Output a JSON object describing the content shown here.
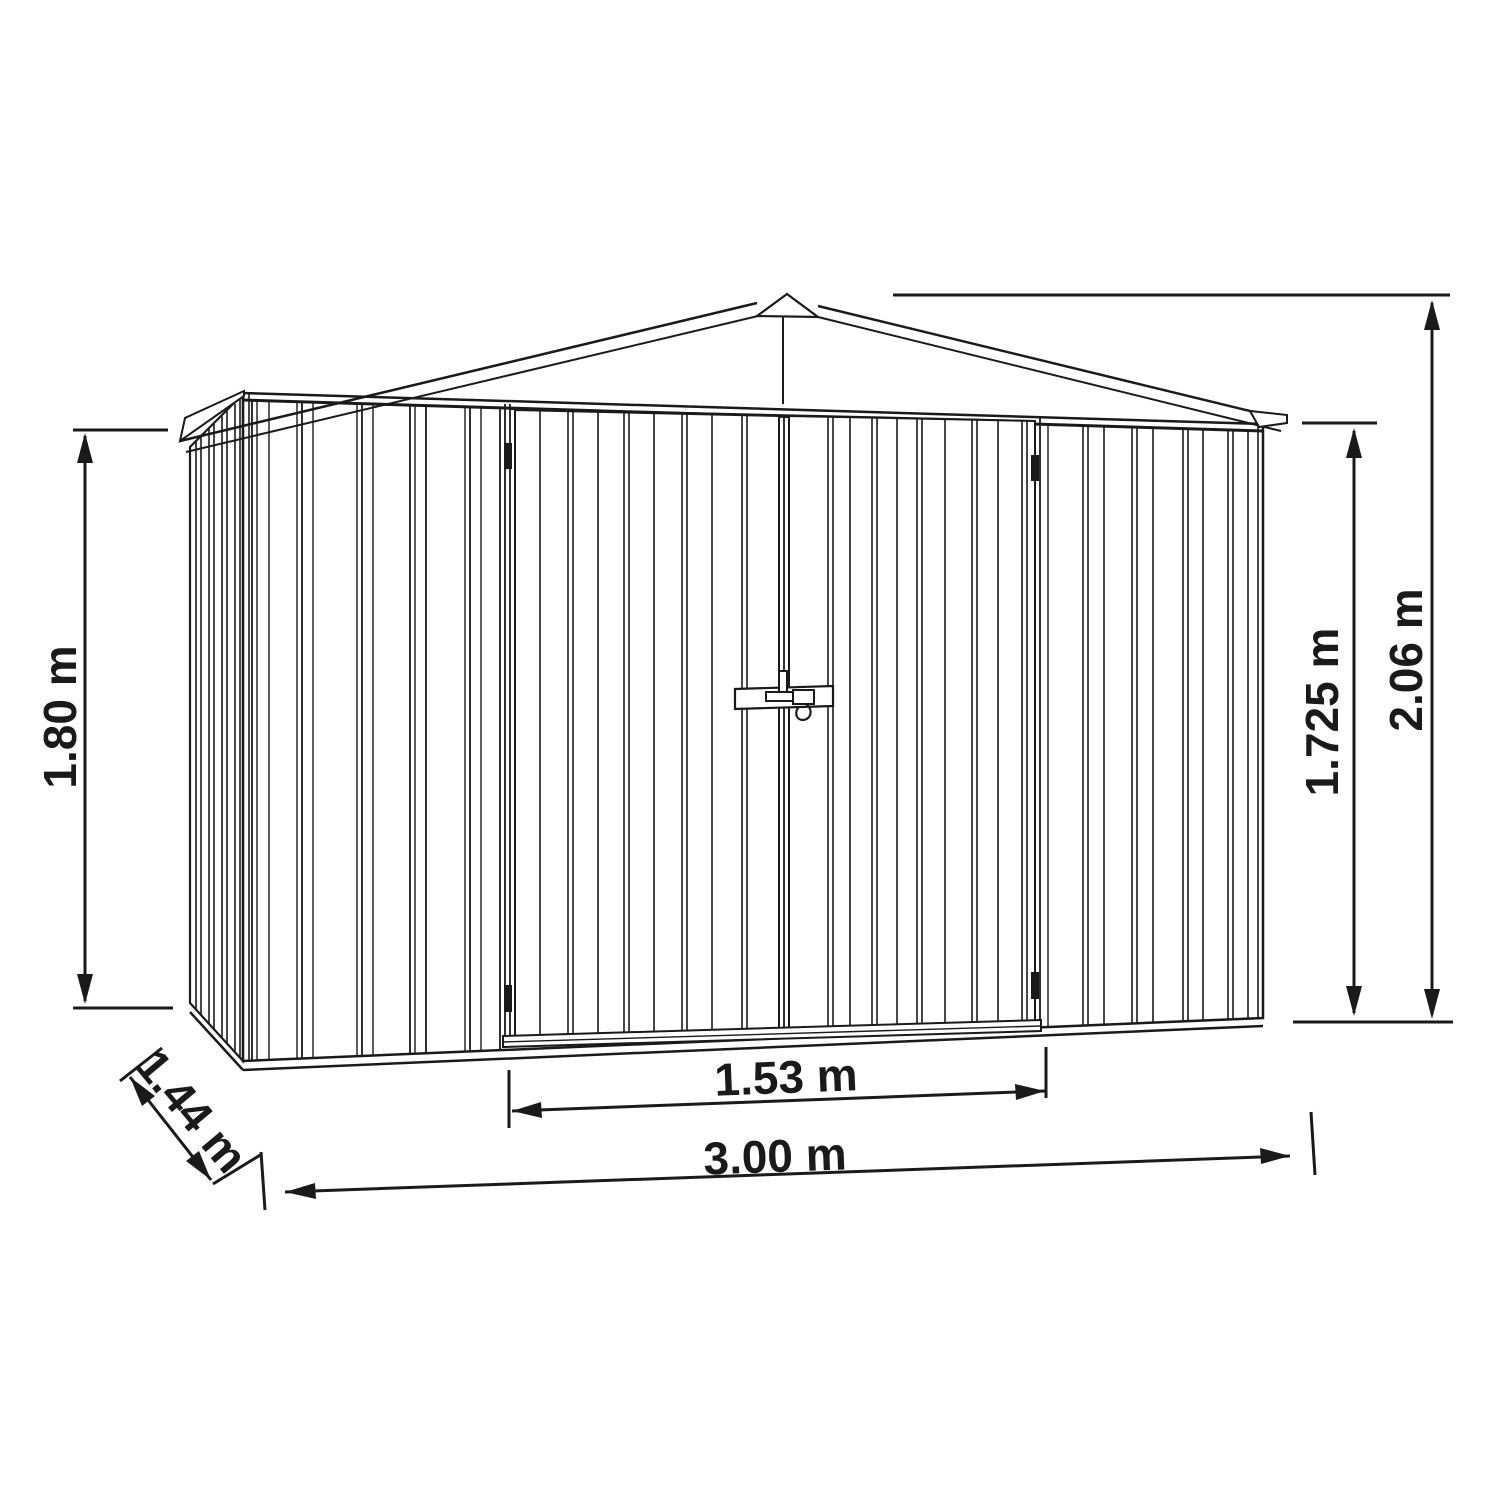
{
  "diagram": {
    "type": "technical-dimension-drawing",
    "subject": "metal garden shed with double doors, front-left perspective elevation",
    "background_color": "#ffffff",
    "line_color": "#1a1a1a",
    "labels": {
      "left_height": "1.80 m",
      "depth": "1.44 m",
      "door_width": "1.53 m",
      "total_width": "3.00 m",
      "eave_height": "1.725 m",
      "ridge_height": "2.06 m"
    }
  }
}
